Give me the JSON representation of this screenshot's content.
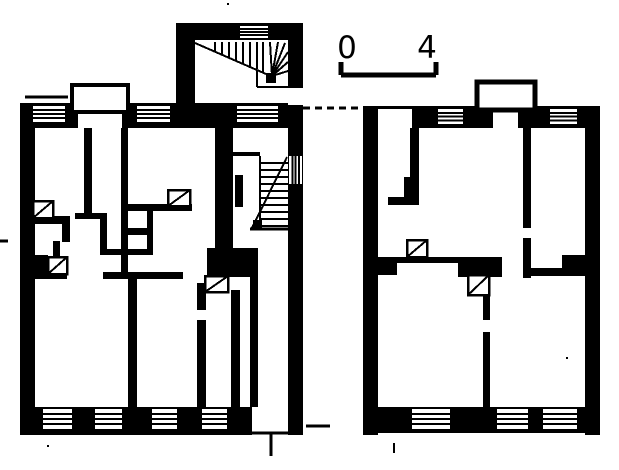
{
  "meta": {
    "description": "Scanned black-and-white architectural ground-floor plan of two adjoining tenement buildings with a winder staircase tower, straight secondary stair, tiled-stove symbols and window symbols",
    "paper_color": "#ffffff",
    "ink_color": "#000000"
  },
  "scale_bar": {
    "start_label": "0",
    "end_label": "4",
    "bar_line": [
      341,
      75,
      436,
      75,
      5
    ],
    "tick_lines": [
      [
        341,
        62,
        341,
        75,
        5
      ],
      [
        436,
        62,
        436,
        75,
        5
      ]
    ]
  },
  "plan": {
    "black_rects": [
      [
        20,
        103,
        15,
        332
      ],
      [
        20,
        103,
        283,
        25
      ],
      [
        20,
        407,
        283,
        28
      ],
      [
        176,
        23,
        19,
        85
      ],
      [
        176,
        23,
        127,
        17
      ],
      [
        288,
        23,
        15,
        412
      ],
      [
        215,
        128,
        18,
        120
      ],
      [
        207,
        248,
        51,
        29
      ],
      [
        250,
        277,
        8,
        131
      ],
      [
        231,
        290,
        9,
        118
      ],
      [
        84,
        128,
        8,
        87
      ],
      [
        121,
        128,
        7,
        150
      ],
      [
        33,
        272,
        34,
        7
      ],
      [
        103,
        272,
        80,
        7
      ],
      [
        121,
        204,
        71,
        7
      ],
      [
        75,
        213,
        30,
        6
      ],
      [
        100,
        213,
        7,
        41
      ],
      [
        121,
        228,
        32,
        7
      ],
      [
        147,
        207,
        6,
        47
      ],
      [
        100,
        249,
        53,
        6
      ],
      [
        33,
        216,
        37,
        8
      ],
      [
        62,
        216,
        8,
        26
      ],
      [
        33,
        255,
        15,
        17
      ],
      [
        53,
        241,
        7,
        16
      ],
      [
        128,
        278,
        9,
        129
      ],
      [
        197,
        283,
        9,
        27
      ],
      [
        197,
        320,
        9,
        87
      ],
      [
        266,
        73,
        10,
        10
      ],
      [
        253,
        220,
        9,
        9
      ],
      [
        235,
        175,
        8,
        32
      ],
      [
        363,
        106,
        15,
        329
      ],
      [
        363,
        106,
        237,
        22
      ],
      [
        585,
        106,
        15,
        329
      ],
      [
        378,
        407,
        222,
        26
      ],
      [
        410,
        128,
        9,
        49
      ],
      [
        404,
        177,
        15,
        22
      ],
      [
        388,
        197,
        31,
        8
      ],
      [
        378,
        257,
        19,
        18
      ],
      [
        397,
        257,
        61,
        6
      ],
      [
        458,
        257,
        44,
        20
      ],
      [
        523,
        128,
        8,
        100
      ],
      [
        523,
        238,
        8,
        40
      ],
      [
        531,
        268,
        54,
        8
      ],
      [
        562,
        255,
        23,
        19
      ],
      [
        483,
        293,
        7,
        27
      ],
      [
        483,
        332,
        7,
        75
      ],
      [
        370,
        226,
        8,
        7
      ]
    ],
    "white_openings": [
      [
        288,
        88,
        15,
        17
      ],
      [
        252,
        407,
        36,
        28
      ],
      [
        378,
        109,
        34,
        19
      ],
      [
        493,
        109,
        25,
        19
      ],
      [
        76,
        110,
        48,
        18
      ]
    ],
    "bay_outlines": [
      [
        72,
        85,
        56,
        27,
        4
      ],
      [
        477,
        82,
        58,
        28,
        5
      ]
    ],
    "windows": [
      [
        33,
        106,
        32,
        16,
        "h",
        3
      ],
      [
        137,
        106,
        33,
        16,
        "h",
        3
      ],
      [
        237,
        106,
        41,
        16,
        "h",
        3
      ],
      [
        240,
        26,
        28,
        12,
        "h",
        3
      ],
      [
        43,
        409,
        29,
        20,
        "h",
        3
      ],
      [
        95,
        409,
        27,
        20,
        "h",
        3
      ],
      [
        152,
        409,
        25,
        20,
        "h",
        3
      ],
      [
        202,
        409,
        25,
        20,
        "h",
        3
      ],
      [
        289,
        156,
        13,
        28,
        "v",
        3
      ],
      [
        438,
        109,
        25,
        15,
        "h",
        3
      ],
      [
        550,
        109,
        27,
        15,
        "h",
        3
      ],
      [
        412,
        409,
        38,
        20,
        "h",
        3
      ],
      [
        497,
        409,
        31,
        20,
        "h",
        3
      ],
      [
        543,
        409,
        34,
        20,
        "h",
        3
      ]
    ],
    "stoves": [
      [
        33,
        201,
        20,
        17
      ],
      [
        168,
        190,
        22,
        16
      ],
      [
        205,
        276,
        23,
        16
      ],
      [
        407,
        240,
        20,
        17
      ],
      [
        468,
        275,
        21,
        20
      ],
      [
        48,
        257,
        19,
        17
      ]
    ],
    "stair_lines": [
      [
        215,
        42,
        215,
        51,
        2
      ],
      [
        222,
        42,
        222,
        54,
        2
      ],
      [
        229,
        42,
        229,
        57,
        2
      ],
      [
        236,
        42,
        236,
        60,
        2
      ],
      [
        243,
        42,
        243,
        63,
        2
      ],
      [
        250,
        42,
        250,
        66,
        2
      ],
      [
        257,
        42,
        257,
        69,
        2
      ],
      [
        263,
        42,
        263,
        72,
        2
      ],
      [
        195,
        43,
        266,
        74,
        2
      ],
      [
        272,
        76,
        270,
        42,
        2
      ],
      [
        272,
        76,
        278,
        42,
        2
      ],
      [
        272,
        76,
        285,
        43,
        2
      ],
      [
        272,
        76,
        288,
        52,
        2
      ],
      [
        272,
        76,
        288,
        62,
        2
      ],
      [
        272,
        76,
        288,
        71,
        2
      ],
      [
        257,
        70,
        257,
        87,
        2
      ],
      [
        257,
        87,
        288,
        87,
        2
      ],
      [
        260,
        156,
        260,
        229,
        2
      ],
      [
        260,
        163,
        288,
        163,
        2
      ],
      [
        260,
        170,
        288,
        170,
        2
      ],
      [
        260,
        177,
        288,
        177,
        2
      ],
      [
        260,
        184,
        288,
        184,
        2
      ],
      [
        260,
        191,
        288,
        191,
        2
      ],
      [
        260,
        198,
        288,
        198,
        2
      ],
      [
        260,
        205,
        288,
        205,
        2
      ],
      [
        260,
        212,
        288,
        212,
        2
      ],
      [
        260,
        219,
        288,
        219,
        2
      ],
      [
        260,
        226,
        288,
        226,
        2
      ],
      [
        252,
        228,
        287,
        157,
        2
      ],
      [
        250,
        229,
        288,
        229,
        3
      ]
    ],
    "detail_lines": [
      [
        77,
        110,
        77,
        128,
        2
      ],
      [
        123,
        110,
        123,
        128,
        2
      ],
      [
        233,
        154,
        260,
        154,
        4
      ],
      [
        251,
        433,
        294,
        433,
        3
      ],
      [
        271,
        433,
        271,
        456,
        3
      ],
      [
        25,
        97,
        68,
        97,
        3
      ],
      [
        0,
        241,
        8,
        241,
        3
      ],
      [
        306,
        426,
        330,
        426,
        3
      ],
      [
        394,
        443,
        394,
        453,
        2
      ]
    ],
    "dashed_lines": [
      [
        303,
        108,
        362,
        108,
        3,
        7,
        5
      ]
    ],
    "specks": [
      [
        227,
        3
      ],
      [
        47,
        445
      ],
      [
        566,
        357
      ]
    ]
  }
}
